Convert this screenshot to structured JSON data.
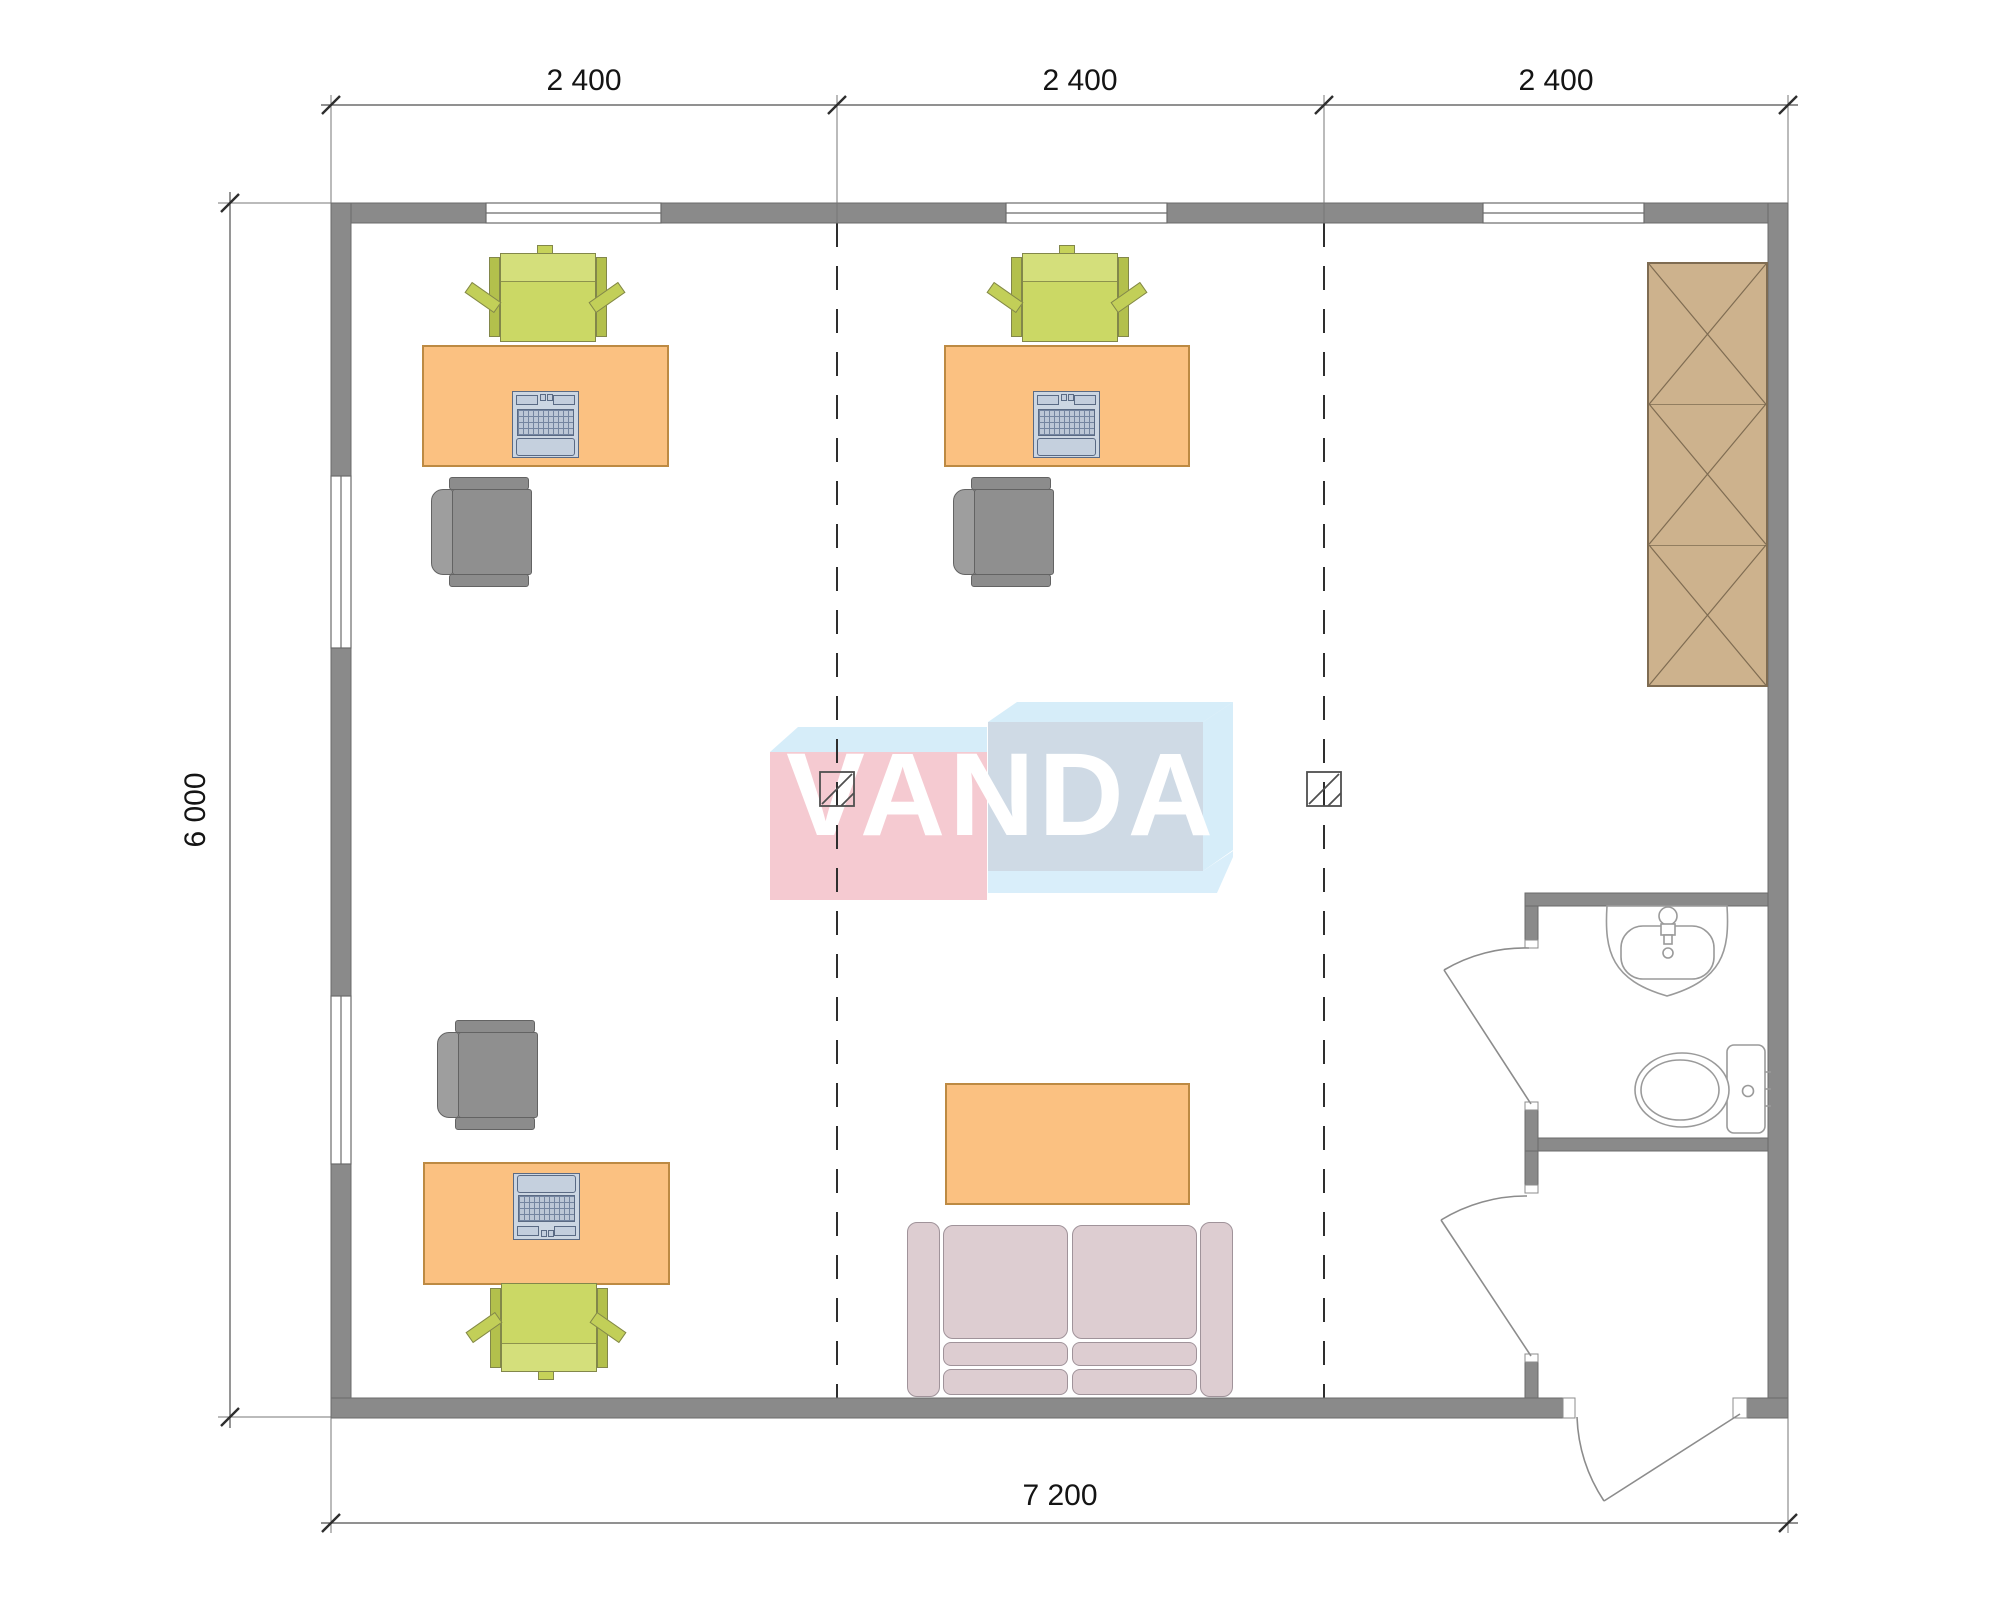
{
  "watermark": {
    "text": "VANDA",
    "pink": "#f5cad1",
    "blue_face": "#cfdae5",
    "sky": "#d6edf9"
  },
  "dimensions": {
    "top_segments": [
      "2 400",
      "2 400",
      "2 400"
    ],
    "left_total": "6 000",
    "bottom_total": "7 200"
  },
  "colors": {
    "wall": "#8a8a8a",
    "desk": "#fbc181",
    "desk_border": "#bd8a43",
    "task_chair": "#cbd865",
    "office_chair": "#8f8f8f",
    "sofa": "#ddcdd1",
    "wardrobe": "#cdb28d",
    "laptop": "#ccd6e2",
    "dashed_grid": "#2e2e2e",
    "fixture_line": "#9a9a9a"
  },
  "fixtures": [
    "sink",
    "toilet"
  ],
  "grid_markers": [
    {
      "x": 837,
      "y": 772
    },
    {
      "x": 1307,
      "y": 772
    }
  ],
  "furniture": {
    "workstations": [
      {
        "id": "workstation-1",
        "desk": {
          "x": 422,
          "y": 345,
          "w": 247,
          "h": 122
        },
        "laptop": {
          "x": 512,
          "y": 391,
          "orient": "up"
        },
        "task_chair": {
          "x": 469,
          "y": 245,
          "orient": "up"
        },
        "office_chair": {
          "x": 431,
          "y": 477
        }
      },
      {
        "id": "workstation-2",
        "desk": {
          "x": 944,
          "y": 345,
          "w": 246,
          "h": 122
        },
        "laptop": {
          "x": 1033,
          "y": 391,
          "orient": "up"
        },
        "task_chair": {
          "x": 991,
          "y": 245,
          "orient": "up"
        },
        "office_chair": {
          "x": 953,
          "y": 477
        }
      },
      {
        "id": "workstation-3",
        "desk": {
          "x": 423,
          "y": 1162,
          "w": 247,
          "h": 123
        },
        "laptop": {
          "x": 513,
          "y": 1173,
          "orient": "down"
        },
        "task_chair": {
          "x": 470,
          "y": 1280,
          "orient": "down"
        },
        "office_chair": {
          "x": 437,
          "y": 1020
        }
      }
    ],
    "sofa": {
      "x": 907,
      "y": 1222,
      "w": 326,
      "h": 175
    },
    "coffee_table": {
      "x": 945,
      "y": 1083,
      "w": 245,
      "h": 122
    },
    "wardrobe": {
      "x": 1647,
      "y": 262,
      "w": 121,
      "h": 425,
      "sections": 3
    }
  }
}
